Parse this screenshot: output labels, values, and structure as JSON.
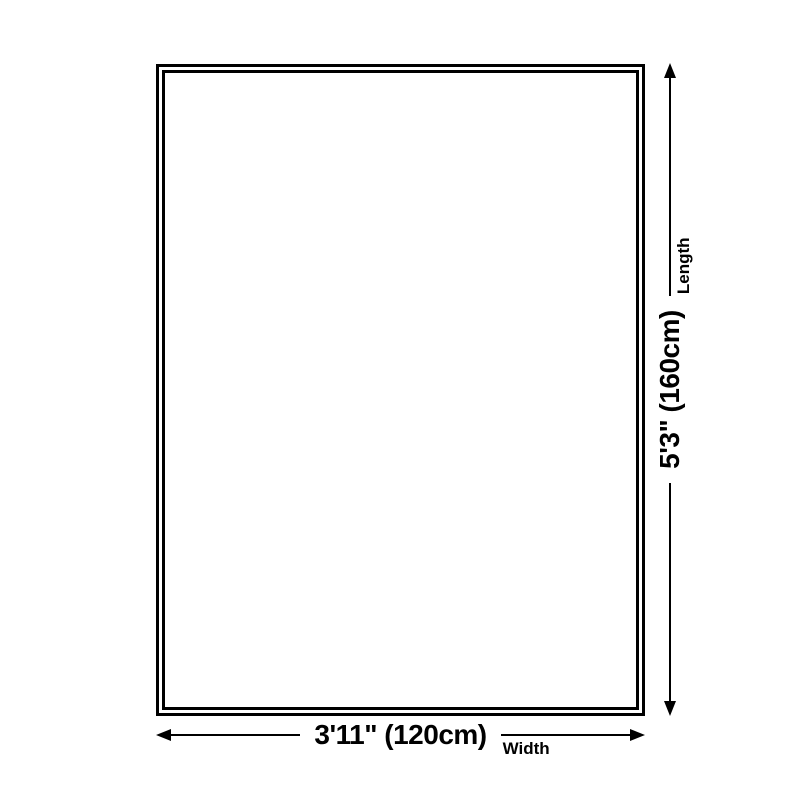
{
  "diagram": {
    "type": "product-size-diagram",
    "background_color": "#ffffff",
    "ink_color": "#000000",
    "shape": "rectangle-double-outline",
    "width_dimension": {
      "value": "3'11\" (120cm)",
      "label": "Width",
      "start_icon": "arrow-left-icon",
      "end_icon": "arrow-right-icon"
    },
    "length_dimension": {
      "value": "5'3\" (160cm)",
      "label": "Length",
      "start_icon": "arrow-down-icon",
      "end_icon": "arrow-up-icon"
    }
  }
}
